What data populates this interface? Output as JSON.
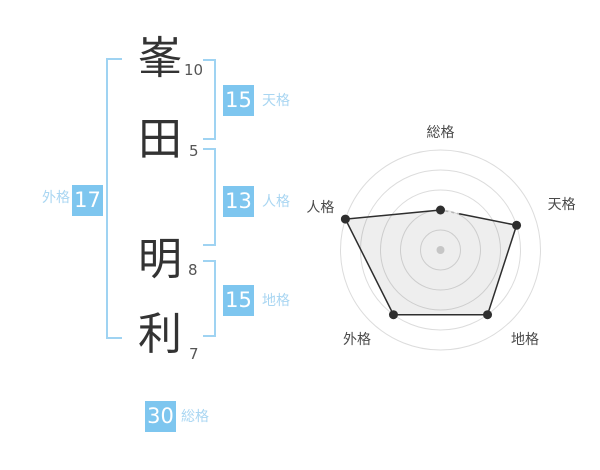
{
  "name_analysis": {
    "characters": [
      {
        "char": "峯",
        "strokes": "10"
      },
      {
        "char": "田",
        "strokes": "5"
      },
      {
        "char": "明",
        "strokes": "8"
      },
      {
        "char": "利",
        "strokes": "7"
      }
    ],
    "badges": {
      "tenkaku": {
        "value": "15",
        "label": "天格"
      },
      "jinkaku": {
        "value": "13",
        "label": "人格"
      },
      "chikaku": {
        "value": "15",
        "label": "地格"
      },
      "gaikaku": {
        "value": "17",
        "label": "外格"
      },
      "soukaku": {
        "value": "30",
        "label": "総格"
      }
    },
    "colors": {
      "badge_bg": "#7ec6ef",
      "badge_text": "#ffffff",
      "label_text": "#a9d6f2",
      "bracket": "#9fd3f2",
      "kanji": "#333333",
      "stroke_count": "#555555"
    }
  },
  "chart_data": {
    "type": "radar",
    "categories": [
      "総格",
      "天格",
      "地格",
      "外格",
      "人格"
    ],
    "values": [
      40,
      80,
      80,
      80,
      100
    ],
    "max": 100,
    "ring_count": 5,
    "grid": "circular",
    "legend": "none",
    "angles_deg": [
      90,
      18,
      -54,
      -126,
      -198
    ],
    "colors": {
      "ring": "#dcdcdc",
      "line": "#2e2e2e",
      "dot": "#2e2e2e",
      "area": "rgba(0,0,0,0.065)",
      "center_dot": "#c6c6c6",
      "label": "#4a4a4a",
      "dash": "#b5b5b5"
    }
  }
}
